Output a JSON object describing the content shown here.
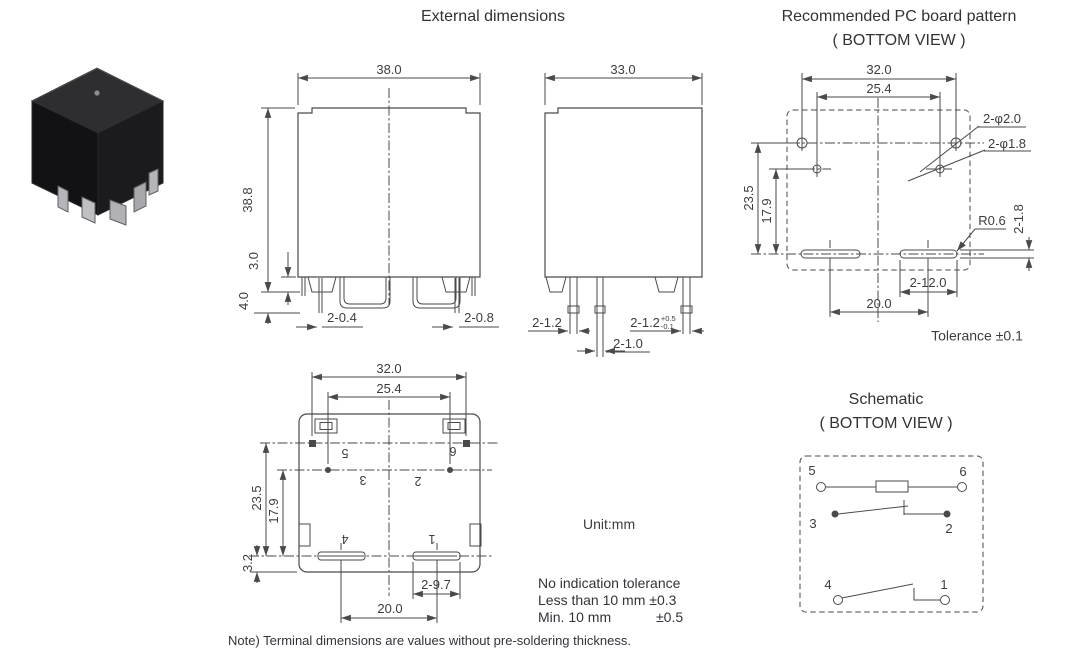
{
  "titles": {
    "external": "External dimensions",
    "pcb1": "Recommended PC board pattern",
    "pcb2": "( BOTTOM VIEW )",
    "sch1": "Schematic",
    "sch2": "( BOTTOM VIEW )"
  },
  "front": {
    "w": "38.0",
    "h": "38.8",
    "standoff": "3.0",
    "pin_len": "4.0",
    "pin_a": "2-0.4",
    "pin_b": "2-0.8"
  },
  "side": {
    "w": "33.0",
    "pin_a": "2-1.2",
    "pin_b": "2-1.2",
    "pin_b_sup": "+0.5",
    "pin_b_sub": "-0.1",
    "pin_c": "2-1.0"
  },
  "pcb": {
    "w1": "32.0",
    "w2": "25.4",
    "h1": "23.5",
    "h2": "17.9",
    "holes_a": "2-φ2.0",
    "holes_b": "2-φ1.8",
    "r": "R0.6",
    "slot_h": "2-1.8",
    "slot_w": "2-12.0",
    "span": "20.0",
    "tol": "Tolerance ±0.1"
  },
  "bottom": {
    "w1": "32.0",
    "w2": "25.4",
    "h1": "23.5",
    "h2": "17.9",
    "h3": "3.2",
    "term": "2-9.7",
    "span": "20.0",
    "p1": "1",
    "p2": "2",
    "p3": "3",
    "p4": "4",
    "p5": "5",
    "p6": "6"
  },
  "sch": {
    "p1": "1",
    "p2": "2",
    "p3": "3",
    "p4": "4",
    "p5": "5",
    "p6": "6"
  },
  "notes": {
    "unit": "Unit:mm",
    "t1": "No indication tolerance",
    "t2": "Less than 10 mm ±0.3",
    "t3": "Min. 10 mm",
    "t3v": "±0.5",
    "foot": "Note) Terminal dimensions are values without pre-soldering thickness."
  },
  "colors": {
    "line": "#4a4a4a",
    "text": "#3d3d3d",
    "photo_top": "#2e2e30",
    "photo_left": "#121214",
    "photo_right": "#1b1b1e"
  }
}
